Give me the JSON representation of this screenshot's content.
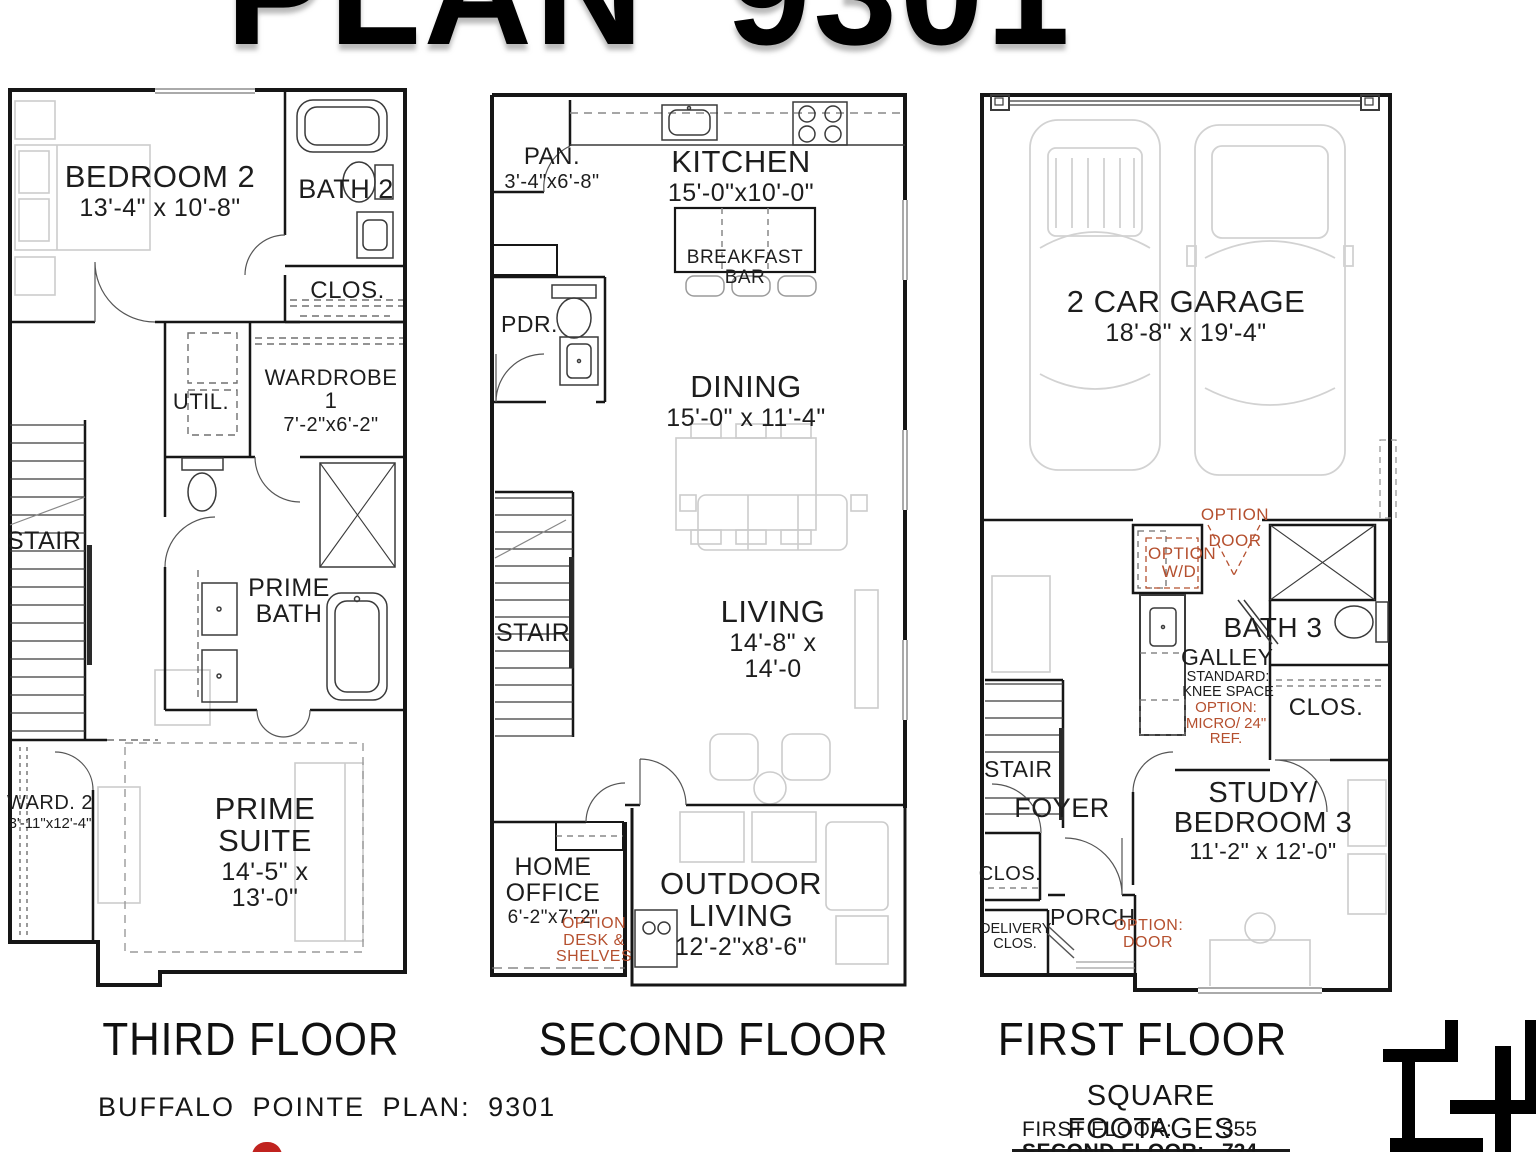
{
  "title": "PLAN 9301",
  "floor_labels": {
    "third": "THIRD FLOOR",
    "second": "SECOND FLOOR",
    "first": "FIRST FLOOR"
  },
  "third": {
    "bedroom2_name": "BEDROOM 2",
    "bedroom2_dims": "13'-4\" x 10'-8\"",
    "bath2": "BATH 2",
    "clos": "CLOS.",
    "wardrobe1_name": "WARDROBE 1",
    "wardrobe1_dims": "7'-2\"x6'-2\"",
    "util": "UTIL.",
    "stair": "STAIR",
    "prime_bath": "PRIME BATH",
    "ward2_name": "WARD. 2",
    "ward2_dims": "3'-11\"x12'-4\"",
    "prime_suite_name": "PRIME SUITE",
    "prime_suite_dims": "14'-5\" x 13'-0\""
  },
  "second": {
    "pan_name": "PAN.",
    "pan_dims": "3'-4\"x6'-8\"",
    "kitchen_name": "KITCHEN",
    "kitchen_dims": "15'-0\"x10'-0\"",
    "breakfast_bar": "BREAKFAST BAR",
    "pdr": "PDR.",
    "dining_name": "DINING",
    "dining_dims": "15'-0\" x 11'-4\"",
    "stair": "STAIR",
    "living_name": "LIVING",
    "living_dims": "14'-8\" x 14'-0",
    "home_office_name": "HOME OFFICE",
    "home_office_dims": "6'-2\"x7'-2\"",
    "option_desk": "OPTION DESK & SHELVES",
    "outdoor_name": "OUTDOOR LIVING",
    "outdoor_dims": "12'-2\"x8'-6\""
  },
  "first": {
    "garage_name": "2 CAR GARAGE",
    "garage_dims": "18'-8\" x 19'-4\"",
    "option_door_top": "OPTION DOOR",
    "option_wd": "OPTION W/D",
    "bath3": "BATH 3",
    "galley": "GALLEY",
    "galley_standard": "STANDARD: KNEE SPACE",
    "galley_option": "OPTION: MICRO/ 24\" REF.",
    "clos_hall": "CLOS.",
    "stair": "STAIR",
    "foyer": "FOYER",
    "clos_foyer": "CLOS.",
    "delivery_clos": "DELIVERY CLOS.",
    "porch": "PORCH",
    "option_door_entry": "OPTION: DOOR",
    "study_name": "STUDY/ BEDROOM 3",
    "study_dims": "11'-2\" x 12'-0\""
  },
  "footer": {
    "plan_text": "BUFFALO POINTE  PLAN:  9301",
    "sq_heading": "SQUARE FOOTAGES",
    "rows": [
      {
        "label": "FIRST FLOOR:",
        "value": "355"
      },
      {
        "label": "SECOND FLOOR:",
        "value": "724"
      }
    ]
  },
  "colors": {
    "option_text": "#b5502f",
    "wall": "#161616",
    "accent_red": "#c0231f"
  }
}
